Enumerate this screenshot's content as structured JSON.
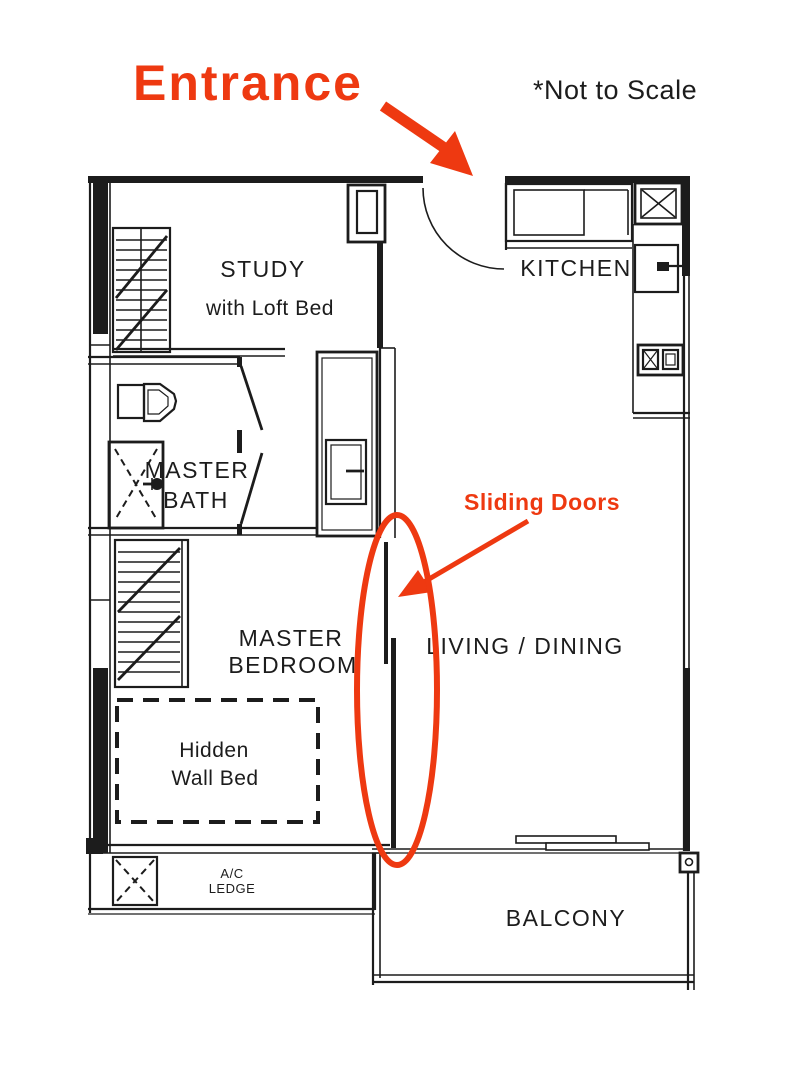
{
  "annotations": {
    "entrance": "Entrance",
    "not_to_scale": "*Not to Scale",
    "sliding_doors": "Sliding Doors"
  },
  "rooms": {
    "study": {
      "name": "STUDY",
      "subtitle": "with Loft Bed"
    },
    "kitchen": {
      "name": "KITCHEN"
    },
    "master_bath": {
      "line1": "MASTER",
      "line2": "BATH"
    },
    "master_bedroom": {
      "line1": "MASTER",
      "line2": "BEDROOM"
    },
    "living_dining": {
      "name": "LIVING / DINING"
    },
    "hidden_wall_bed": {
      "line1": "Hidden",
      "line2": "Wall Bed"
    },
    "ac_ledge": {
      "line1": "A/C",
      "line2": "LEDGE"
    },
    "balcony": {
      "name": "BALCONY"
    }
  },
  "icons": {
    "entrance-arrow-icon": "red diagonal arrow",
    "sliding-doors-arrow-icon": "red diagonal arrow",
    "sliding-doors-ellipse-icon": "red highlight ellipse"
  },
  "colors": {
    "annotation_red": "#EE3911",
    "plan_black": "#1c1c1c",
    "background": "#ffffff"
  }
}
